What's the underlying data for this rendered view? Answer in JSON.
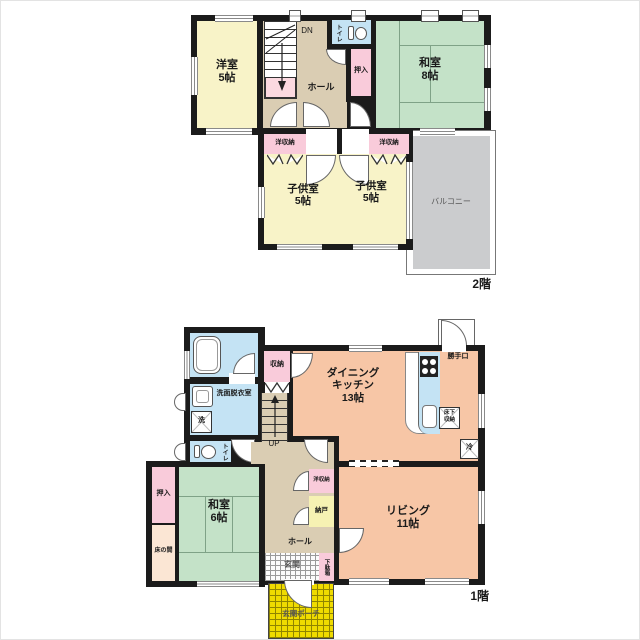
{
  "second_floor": {
    "floor_label": "2階",
    "stair_label": "DN",
    "rooms": {
      "western_room": {
        "name": "洋室",
        "size": "5帖"
      },
      "japanese_room": {
        "name": "和室",
        "size": "8帖"
      },
      "child_room_left": {
        "name": "子供室",
        "size": "5帖"
      },
      "child_room_right": {
        "name": "子供室",
        "size": "5帖"
      },
      "hall": "ホール",
      "toilet": "トイレ",
      "closet": "押入",
      "storage_left": "洋収納",
      "storage_right": "洋収納",
      "balcony": "バルコニー"
    }
  },
  "first_floor": {
    "floor_label": "1階",
    "stair_label": "UP",
    "rooms": {
      "dining_kitchen": {
        "name1": "ダイニング",
        "name2": "キッチン",
        "size": "13帖"
      },
      "living": {
        "name": "リビング",
        "size": "11帖"
      },
      "japanese_room": {
        "name": "和室",
        "size": "6帖"
      },
      "hall": "ホール",
      "washroom": "洗面脱衣室",
      "toilet": "トイレ",
      "storage": "収納",
      "closet": "押入",
      "tokonoma": "床の間",
      "western_storage": "洋収納",
      "storeroom": "納戸",
      "entrance": "玄関",
      "shoe_cabinet": "下駄箱",
      "porch": "玄関ポーチ",
      "back_door": "勝手口",
      "underfloor_storage_line1": "床下",
      "underfloor_storage_line2": "収納",
      "fridge": "冷",
      "washer": "洗"
    }
  },
  "colors": {
    "wall": "#1b1b1b",
    "western_room_cream": "#F8F3C8",
    "tatami_green": "#C4E2C8",
    "hall_beige": "#DACDB3",
    "closet_pink": "#F9CBDA",
    "water_blue": "#C4E3F4",
    "ldk_peach": "#F7C6A6",
    "balcony_gray": "#CBCCCE",
    "porch_yellow": "#EFDB00",
    "storeroom_yellow": "#F6F2B3",
    "tokonoma_cream": "#FBE6D4",
    "stair_landing_pink": "#FBD9E0"
  }
}
